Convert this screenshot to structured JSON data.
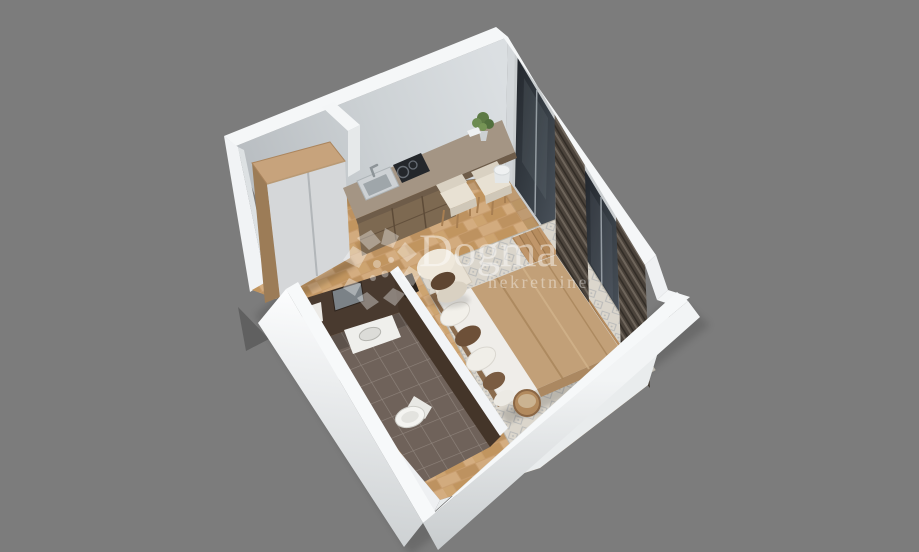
{
  "watermark": {
    "brand": "Dogma",
    "subtitle": "nekretnine"
  },
  "background": "#7c7c7c",
  "palette": {
    "bg": "#7c7c7c",
    "watermark": "#ffffff",
    "wallTop": "#f5f7f8",
    "wallFaceLight": "#d9dde0",
    "wallFaceMid": "#c9ced1",
    "woodFloor": "#c89d6e",
    "rugBase": "#dbd6cc",
    "rugPattern": "#9aa0a8",
    "bathTile": "#6f625a",
    "darkWood": "#493a2f",
    "curtain": "#4b433b",
    "glass": "#2b3137",
    "counterTop": "#a49584",
    "cabinetWood": "#7d6951",
    "wardrobeDoor": "#d5d7d9",
    "wardrobeWood": "#c7a37c",
    "creamFabric": "#e8e1d4",
    "blanket": "#c2a078",
    "mattress": "#efede9",
    "pillowBrown": "#6d5038",
    "arrow": "#606060"
  },
  "scene": {
    "type": "3d-isometric-floor-plan-render",
    "objects": [
      "entrance-arrow",
      "entrance-doorway",
      "wardrobe",
      "kitchen-counter",
      "kitchen-sink",
      "cooktop",
      "dining-chair-1",
      "dining-chair-2",
      "desk-plant",
      "window-1",
      "curtain-1",
      "window-2",
      "curtain-2",
      "armchair",
      "area-rug",
      "bed",
      "side-table",
      "partition-wall",
      "bathroom-vanity-wall",
      "bathroom-mirror",
      "bathroom-sink",
      "toilet",
      "towel",
      "bathroom-floor"
    ]
  }
}
